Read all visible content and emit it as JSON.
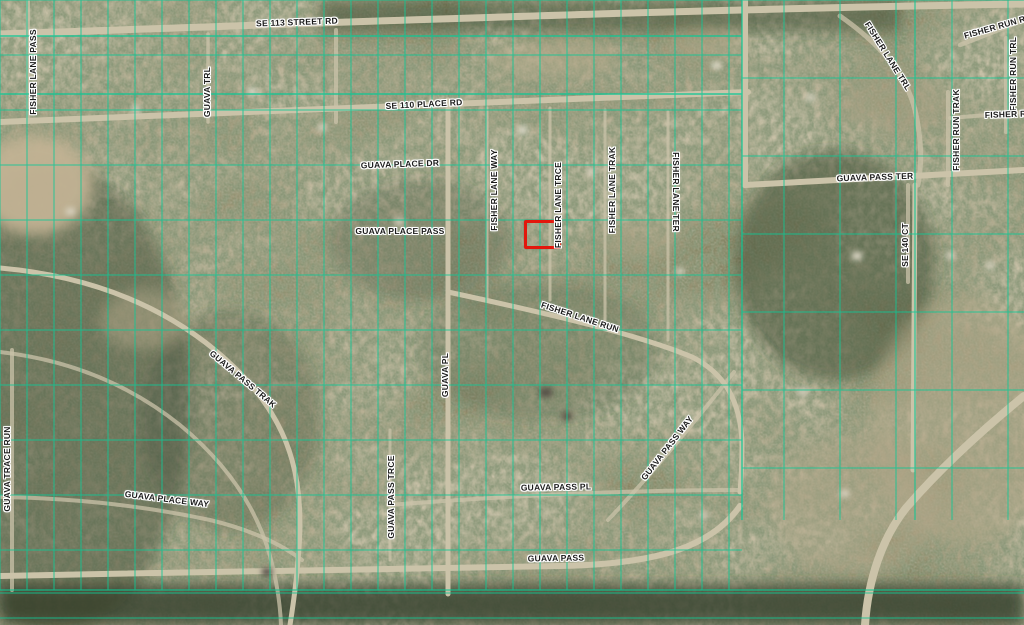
{
  "map": {
    "type": "aerial-parcel-map",
    "colors": {
      "parcel_line": "#10c795",
      "road": "#cbc3a9",
      "label_text": "#1b1b1b",
      "label_halo": "#ffffff",
      "highlight": "#e3170c"
    },
    "highlight": {
      "x": 524,
      "y": 220,
      "w": 31,
      "h": 23
    },
    "labels": [
      {
        "text": "SE 113 STREET RD",
        "x": 297,
        "y": 22,
        "deg": -2
      },
      {
        "text": "SE 110 PLACE RD",
        "x": 424,
        "y": 104,
        "deg": -3
      },
      {
        "text": "GUAVA PLACE DR",
        "x": 400,
        "y": 164,
        "deg": -2
      },
      {
        "text": "GUAVA PLACE PASS",
        "x": 400,
        "y": 231,
        "deg": 0
      },
      {
        "text": "FISHER LANE PASS",
        "x": 33,
        "y": 72,
        "deg": -90
      },
      {
        "text": "GUAVA TRL",
        "x": 207,
        "y": 92,
        "deg": -90
      },
      {
        "text": "FISHER LANE WAY",
        "x": 494,
        "y": 190,
        "deg": -90
      },
      {
        "text": "FISHER LANE TRCE",
        "x": 558,
        "y": 205,
        "deg": -90
      },
      {
        "text": "FISHER LANE TRAK",
        "x": 612,
        "y": 190,
        "deg": -90
      },
      {
        "text": "FISHER LANE TER",
        "x": 676,
        "y": 192,
        "deg": 90
      },
      {
        "text": "FISHER LANE RUN",
        "x": 580,
        "y": 317,
        "deg": 18
      },
      {
        "text": "FISHER LANE TRL",
        "x": 888,
        "y": 56,
        "deg": 58
      },
      {
        "text": "FISHER RUN ROW",
        "x": 1002,
        "y": 25,
        "deg": -16
      },
      {
        "text": "FISHER RUN TRL",
        "x": 1013,
        "y": 74,
        "deg": -90
      },
      {
        "text": "FISHER RUN TRAK",
        "x": 956,
        "y": 130,
        "deg": -90
      },
      {
        "text": "FISHER RUN",
        "x": 1012,
        "y": 114,
        "deg": -2
      },
      {
        "text": "GUAVA PASS TER",
        "x": 875,
        "y": 177,
        "deg": -2
      },
      {
        "text": "SE 140 CT",
        "x": 905,
        "y": 245,
        "deg": -90
      },
      {
        "text": "GUAVA PL",
        "x": 445,
        "y": 375,
        "deg": -90
      },
      {
        "text": "GUAVA PASS TRAK",
        "x": 243,
        "y": 379,
        "deg": 40
      },
      {
        "text": "GUAVA PASS WAY",
        "x": 667,
        "y": 448,
        "deg": -52
      },
      {
        "text": "GUAVA PASS PL",
        "x": 556,
        "y": 487,
        "deg": -1
      },
      {
        "text": "GUAVA PASS",
        "x": 556,
        "y": 558,
        "deg": -1
      },
      {
        "text": "GUAVA PLACE WAY",
        "x": 167,
        "y": 499,
        "deg": 7
      },
      {
        "text": "GUAVA PASS TRCE",
        "x": 391,
        "y": 497,
        "deg": -90
      },
      {
        "text": "GUAVA TRACE RUN",
        "x": 7,
        "y": 469,
        "deg": -90
      }
    ]
  }
}
